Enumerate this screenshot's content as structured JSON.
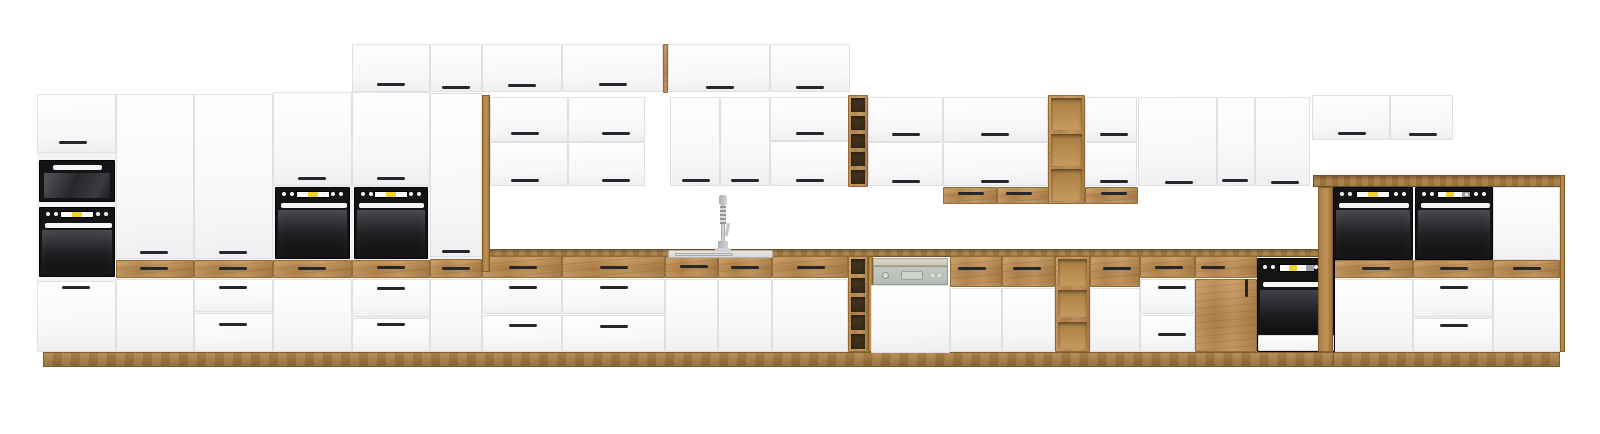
{
  "title": "Modular kitchen set product image - white fronts with oak accents and black appliances",
  "canvas": {
    "w": 1600,
    "h": 434
  },
  "palette": {
    "background": "#ffffff",
    "cabinet_white": "#f9f9fb",
    "cabinet_edge": "#e0e0e4",
    "oak": "#bd8b4f",
    "oak_dark": "#8e6836",
    "appliance_black": "#141416",
    "appliance_glass": "#2a2a2f",
    "appliance_bar_white": "#f6f6f6",
    "display_yellow": "#f2d233",
    "display_white": "#fafafa",
    "display_gray": "#9aa0a3",
    "handle_dark": "#26262b",
    "dishwasher_panel": "#b6bbb5",
    "dishwasher_strip": "#cdc9b7",
    "sink_steel": "#d9d9d6",
    "faucet_steel": "#bcc0c2",
    "rack_cell_dark": "#362917",
    "shelf_cell_light": "#c79a5e"
  },
  "scene": {
    "columns": [
      [
        "tower-a-body",
        37,
        94,
        79,
        258
      ],
      [
        "tower-b-body",
        116,
        94,
        78,
        258
      ],
      [
        "tower-c-body",
        194,
        94,
        79,
        258
      ],
      [
        "tower-d-body",
        273,
        92,
        79,
        260
      ],
      [
        "tower-e-body",
        352,
        92,
        78,
        260
      ],
      [
        "tall-cabinet-body",
        430,
        93,
        52,
        259
      ],
      [
        "raised-section-body",
        1333,
        187,
        227,
        165
      ]
    ],
    "plinths": [
      [
        "plinth-main",
        43,
        352,
        1292,
        15
      ],
      [
        "plinth-raised",
        1333,
        352,
        227,
        15
      ]
    ],
    "counters": [
      [
        "worktop-main",
        482,
        249,
        853,
        8
      ],
      [
        "worktop-raised",
        1313,
        175,
        252,
        12
      ]
    ],
    "wood_fronts": [
      [
        "tower-b-oak-drawer",
        116,
        260,
        78,
        18
      ],
      [
        "tower-c-oak-drawer",
        194,
        260,
        79,
        18
      ],
      [
        "tower-d-oak-drawer",
        273,
        260,
        79,
        18
      ],
      [
        "tower-e-oak-drawer",
        352,
        260,
        78,
        18
      ],
      [
        "tall-cabinet-oak-drawer",
        430,
        259,
        52,
        19
      ],
      [
        "top-box-oak-strip",
        663,
        44,
        5,
        49
      ],
      [
        "oak-drawer-base-1",
        482,
        256,
        80,
        22
      ],
      [
        "oak-drawer-base-2",
        562,
        256,
        103,
        22
      ],
      [
        "oak-drawer-sink-left",
        665,
        256,
        53,
        22
      ],
      [
        "oak-drawer-sink-right",
        718,
        256,
        54,
        22
      ],
      [
        "oak-drawer-base-3",
        772,
        256,
        76,
        22
      ],
      [
        "oak-drawer-base-4a",
        950,
        256,
        52,
        31
      ],
      [
        "oak-drawer-base-4b",
        1002,
        256,
        53,
        31
      ],
      [
        "oak-drawer-base-5",
        1090,
        256,
        50,
        31
      ],
      [
        "oak-drawer-base-6",
        1140,
        256,
        55,
        22
      ],
      [
        "under-cabinet-drawer-1a",
        943,
        187,
        54,
        17
      ],
      [
        "under-cabinet-drawer-1b",
        997,
        187,
        53,
        17
      ],
      [
        "under-cabinet-drawer-2",
        1085,
        187,
        53,
        17
      ],
      [
        "oak-cabinet-drawer",
        1195,
        256,
        62,
        22
      ],
      [
        "oak-cabinet-door",
        1195,
        279,
        62,
        73
      ],
      [
        "raised-oak-drawer-1",
        1333,
        260,
        80,
        18
      ],
      [
        "raised-oak-drawer-2",
        1413,
        260,
        80,
        18
      ],
      [
        "raised-oak-drawer-3",
        1493,
        260,
        67,
        18
      ]
    ],
    "white_fronts": [
      [
        "tower-a-top-door",
        37,
        94,
        79,
        59
      ],
      [
        "tower-a-bottom-door",
        37,
        281,
        79,
        71
      ],
      [
        "tower-b-door",
        116,
        94,
        78,
        165
      ],
      [
        "tower-b-bottom-door",
        116,
        279,
        78,
        73
      ],
      [
        "tower-c-door",
        194,
        94,
        79,
        165
      ],
      [
        "tower-c-drawer-1",
        194,
        279,
        79,
        33
      ],
      [
        "tower-c-drawer-2",
        194,
        313,
        79,
        39
      ],
      [
        "tower-d-door",
        273,
        92,
        79,
        94
      ],
      [
        "tower-d-bottom-door",
        273,
        279,
        79,
        73
      ],
      [
        "tower-e-top-box",
        352,
        44,
        78,
        48
      ],
      [
        "tower-e-door",
        352,
        92,
        78,
        94
      ],
      [
        "tower-e-drawer-1",
        352,
        279,
        78,
        38
      ],
      [
        "tower-e-drawer-2",
        352,
        318,
        78,
        34
      ],
      [
        "tall-cabinet-top-box",
        430,
        44,
        52,
        48
      ],
      [
        "tall-cabinet-door",
        430,
        93,
        52,
        164
      ],
      [
        "tall-cabinet-bottom-door",
        430,
        279,
        52,
        73
      ],
      [
        "top-box-1",
        482,
        44,
        80,
        48
      ],
      [
        "top-box-2",
        562,
        44,
        101,
        48
      ],
      [
        "top-box-3",
        668,
        44,
        102,
        48
      ],
      [
        "top-box-4",
        770,
        44,
        80,
        48
      ],
      [
        "wall-cab-1-upper-door",
        490,
        97,
        78,
        45
      ],
      [
        "wall-cab-1-lower-door",
        490,
        142,
        78,
        44
      ],
      [
        "wall-cab-2-upper-door",
        568,
        97,
        77,
        45
      ],
      [
        "wall-cab-2-lower-door",
        568,
        142,
        77,
        44
      ],
      [
        "wall-cab-3-left-door",
        670,
        97,
        50,
        89
      ],
      [
        "wall-cab-3-right-door",
        720,
        97,
        50,
        89
      ],
      [
        "wall-cab-4-upper-flap",
        770,
        97,
        80,
        44
      ],
      [
        "wall-cab-4-lower-flap",
        770,
        141,
        80,
        45
      ],
      [
        "wall-cab-5-upper-door",
        868,
        97,
        75,
        45
      ],
      [
        "wall-cab-5-lower-door",
        868,
        142,
        75,
        44
      ],
      [
        "wall-cab-6-upper-flap",
        943,
        97,
        105,
        45
      ],
      [
        "wall-cab-6-lower-flap",
        943,
        142,
        105,
        44
      ],
      [
        "wall-cab-7-upper-door",
        1085,
        97,
        52,
        45
      ],
      [
        "wall-cab-7-lower-door",
        1085,
        142,
        52,
        44
      ],
      [
        "wall-cab-8-door",
        1138,
        97,
        79,
        89
      ],
      [
        "wall-cab-9-door",
        1217,
        97,
        38,
        89
      ],
      [
        "wall-cab-10-door",
        1255,
        97,
        55,
        89
      ],
      [
        "wall-box-right-1",
        1312,
        95,
        78,
        45
      ],
      [
        "wall-box-right-2",
        1390,
        95,
        63,
        45
      ],
      [
        "base-1-drawer-1",
        482,
        279,
        80,
        35
      ],
      [
        "base-1-drawer-2",
        482,
        315,
        80,
        37
      ],
      [
        "base-2-drawer-1",
        562,
        279,
        103,
        35
      ],
      [
        "base-2-drawer-2",
        562,
        315,
        103,
        37
      ],
      [
        "sink-cabinet-left-door",
        665,
        279,
        53,
        73
      ],
      [
        "sink-cabinet-right-door",
        718,
        279,
        54,
        73
      ],
      [
        "base-3-door",
        772,
        279,
        76,
        73
      ],
      [
        "base-4-left-door",
        950,
        288,
        52,
        64
      ],
      [
        "base-4-right-door",
        1002,
        288,
        53,
        64
      ],
      [
        "base-5-door",
        1090,
        288,
        50,
        64
      ],
      [
        "base-6-drawer-1",
        1140,
        279,
        55,
        35
      ],
      [
        "base-6-drawer-2",
        1140,
        315,
        55,
        37
      ],
      [
        "raised-mid-white-door",
        1493,
        187,
        67,
        73
      ],
      [
        "raised-base-1-door",
        1333,
        279,
        80,
        73
      ],
      [
        "raised-base-2-drawer-1",
        1413,
        279,
        80,
        38
      ],
      [
        "raised-base-2-drawer-2",
        1413,
        318,
        80,
        34
      ],
      [
        "raised-base-3-door",
        1493,
        279,
        67,
        73
      ]
    ],
    "panels": [
      [
        "oak-side-panel-wall",
        482,
        95,
        8,
        177,
        6
      ],
      [
        "oak-side-strip-dishwasher",
        868,
        256,
        5,
        96,
        6
      ],
      [
        "raised-left-side-panel",
        1318,
        187,
        15,
        165,
        25
      ],
      [
        "raised-right-side-panel",
        1560,
        175,
        5,
        177,
        25
      ]
    ],
    "racks": [
      [
        "wine-rack-wall",
        848,
        95,
        20,
        92,
        5,
        "dark"
      ],
      [
        "wine-rack-base",
        848,
        256,
        20,
        96,
        5,
        "dark"
      ],
      [
        "open-shelf-wall",
        1048,
        95,
        37,
        109,
        3,
        "light"
      ],
      [
        "open-shelf-base",
        1055,
        256,
        35,
        96,
        3,
        "light"
      ]
    ],
    "appliances": [
      [
        "microwave",
        39,
        160,
        76,
        42
      ],
      [
        "oven-tower",
        39,
        207,
        76,
        70
      ],
      [
        "oven-mid-left",
        275,
        187,
        75,
        72
      ],
      [
        "oven-mid-right",
        354,
        187,
        74,
        72
      ],
      [
        "oven-high-left",
        1333,
        187,
        80,
        73
      ],
      [
        "oven-high-right",
        1415,
        187,
        78,
        73
      ],
      [
        "base-oven",
        1257,
        258,
        78,
        94
      ],
      [
        "dishwasher",
        871,
        258,
        79,
        95
      ],
      [
        "sink",
        668,
        250,
        105,
        8
      ],
      [
        "faucet",
        712,
        195,
        22,
        57
      ]
    ],
    "handles": [
      [
        59,
        141
      ],
      [
        62,
        286
      ],
      [
        140,
        251
      ],
      [
        140,
        267
      ],
      [
        219,
        251
      ],
      [
        219,
        267
      ],
      [
        219,
        286
      ],
      [
        219,
        323
      ],
      [
        298,
        177
      ],
      [
        298,
        267
      ],
      [
        377,
        83
      ],
      [
        377,
        177
      ],
      [
        377,
        266
      ],
      [
        377,
        287
      ],
      [
        377,
        323
      ],
      [
        442,
        86
      ],
      [
        442,
        250
      ],
      [
        442,
        267
      ],
      [
        508,
        84
      ],
      [
        599,
        83
      ],
      [
        706,
        86
      ],
      [
        796,
        86
      ],
      [
        511,
        132
      ],
      [
        511,
        179
      ],
      [
        602,
        132
      ],
      [
        602,
        179
      ],
      [
        682,
        179
      ],
      [
        731,
        179
      ],
      [
        796,
        132
      ],
      [
        796,
        179
      ],
      [
        509,
        266
      ],
      [
        509,
        286
      ],
      [
        509,
        324
      ],
      [
        600,
        266
      ],
      [
        600,
        286
      ],
      [
        600,
        325
      ],
      [
        680,
        265
      ],
      [
        731,
        266
      ],
      [
        797,
        266
      ],
      [
        892,
        133
      ],
      [
        892,
        180
      ],
      [
        981,
        133
      ],
      [
        981,
        180
      ],
      [
        1100,
        133
      ],
      [
        1100,
        180
      ],
      [
        958,
        192,
        26
      ],
      [
        1006,
        192,
        26
      ],
      [
        1101,
        192,
        26
      ],
      [
        1165,
        181
      ],
      [
        1222,
        179,
        26
      ],
      [
        1271,
        181
      ],
      [
        958,
        267
      ],
      [
        1013,
        267
      ],
      [
        1103,
        267
      ],
      [
        1155,
        266
      ],
      [
        1158,
        286
      ],
      [
        1158,
        333
      ],
      [
        1201,
        266,
        24
      ],
      [
        1245,
        279,
        3,
        18
      ],
      [
        1338,
        132
      ],
      [
        1409,
        133
      ],
      [
        1362,
        267
      ],
      [
        1440,
        267
      ],
      [
        1513,
        267
      ],
      [
        1440,
        286
      ],
      [
        1440,
        324
      ]
    ]
  }
}
